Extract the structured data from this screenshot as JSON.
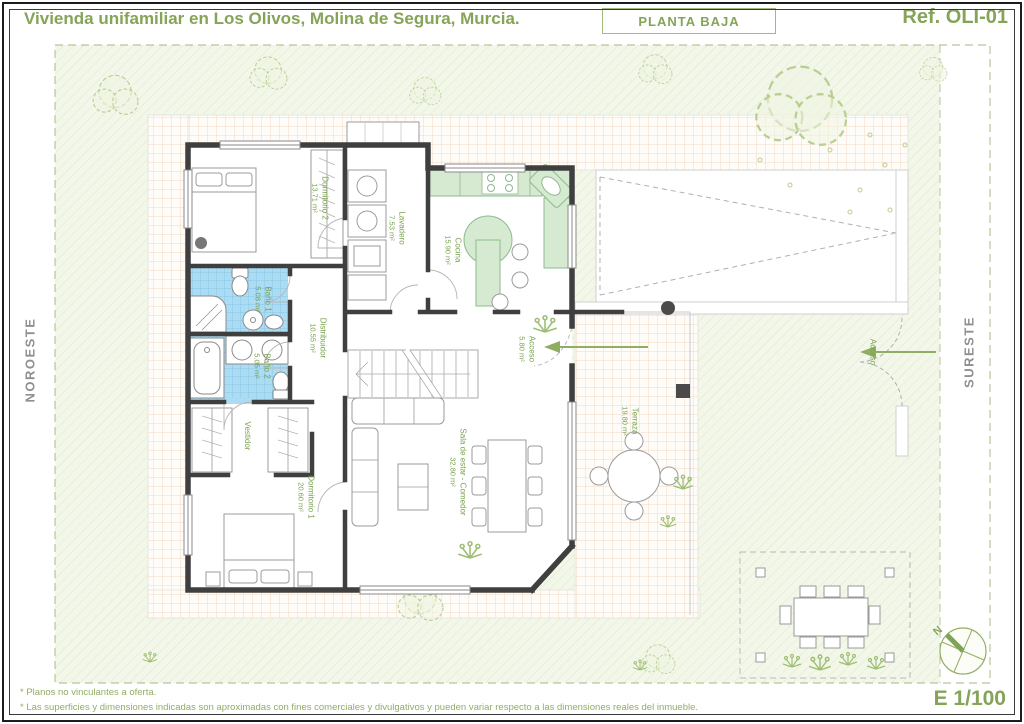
{
  "header": {
    "title": "Vivienda unifamiliar en Los Olivos, Molina de Segura, Murcia.",
    "plan_label": "PLANTA BAJA",
    "reference": "Ref. OLI-01"
  },
  "orientation": {
    "left_label": "NOROESTE",
    "right_label": "SURESTE",
    "compass_north": "N"
  },
  "rooms": {
    "dormitorio2": {
      "name": "Dormitorio 2",
      "area": "13.71 m²"
    },
    "lavadero": {
      "name": "Lavadero",
      "area": "7.53 m²"
    },
    "cocina": {
      "name": "Cocina",
      "area": "15.90 m²"
    },
    "bano1": {
      "name": "Baño 1",
      "area": "5.08 m²"
    },
    "bano2": {
      "name": "Baño 2",
      "area": "5.05 m²"
    },
    "distribuidor": {
      "name": "Distribuidor",
      "area": "10.55 m²"
    },
    "acceso": {
      "name": "Acceso",
      "area": "5.80 m²"
    },
    "vestidor": {
      "name": "Vestidor",
      "area": ""
    },
    "dormitorio1": {
      "name": "Dormitorio 1",
      "area": "20.60 m²"
    },
    "sala": {
      "name": "Sala de estar - Comedor",
      "area": "32.80 m²"
    },
    "terraza": {
      "name": "Terraza",
      "area": "19.80 m²"
    }
  },
  "site": {
    "entrance_label": "Acceso"
  },
  "footer": {
    "note1": "* Planos no vinculantes a oferta.",
    "note2": "* Las superficies y dimensiones indicadas son aproximadas con fines comerciales y divulgativos y pueden variar respecto a las dimensiones reales del inmueble.",
    "scale_label": "E 1/100"
  },
  "colors": {
    "accent_green": "#85a458",
    "wall_dark": "#3f3f3f",
    "bath_tile": "#abdcf3",
    "kitchen_counter": "#d6ead2",
    "paving_line": "#f3d8c0",
    "garden_line": "#dde8c9"
  }
}
